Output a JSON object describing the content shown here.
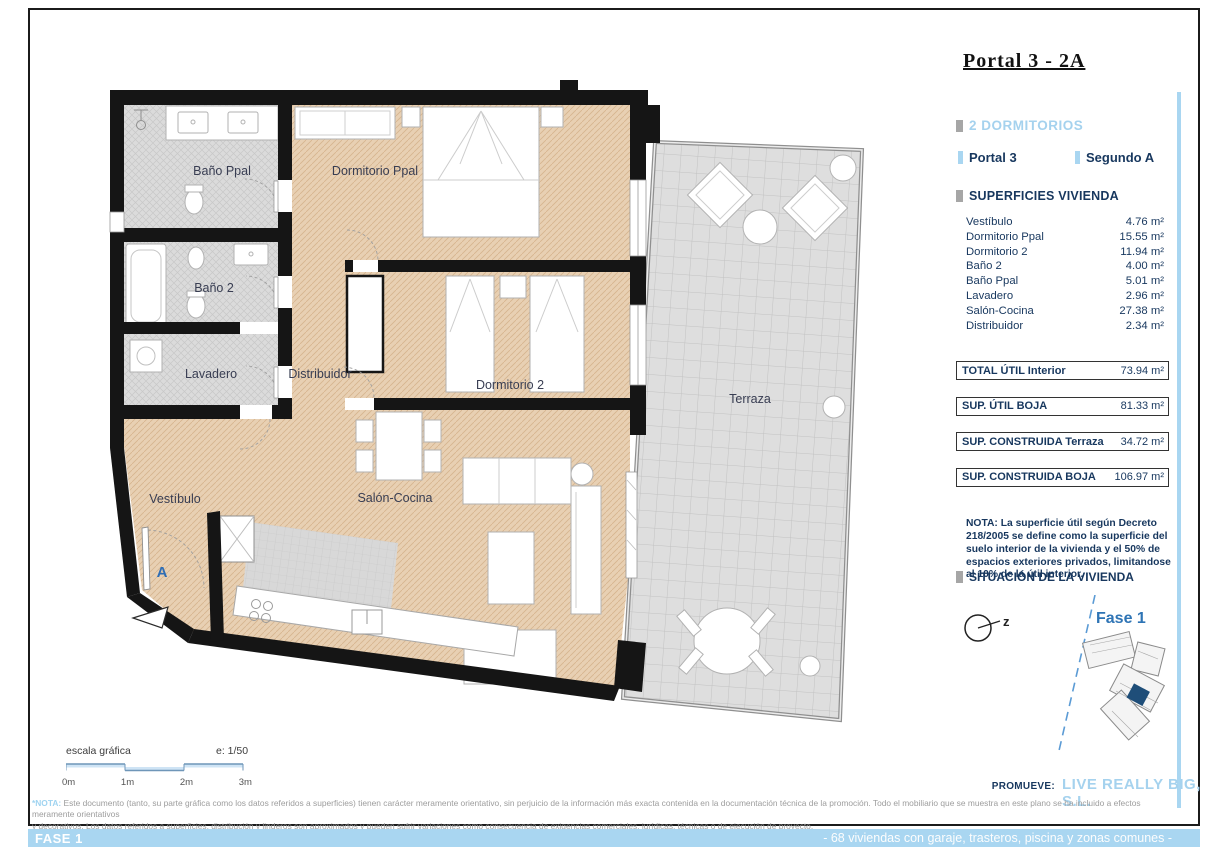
{
  "title": "Portal 3 - 2A",
  "panel": {
    "bedrooms_label": "2 DORMITORIOS",
    "portal_label": "Portal  3",
    "floor_label": "Segundo  A",
    "surfaces_header": "SUPERFICIES VIVIENDA",
    "rooms": [
      {
        "name": "Vestíbulo",
        "area": "4.76 m²"
      },
      {
        "name": "Dormitorio Ppal",
        "area": "15.55 m²"
      },
      {
        "name": "Dormitorio 2",
        "area": "11.94 m²"
      },
      {
        "name": "Baño 2",
        "area": "4.00 m²"
      },
      {
        "name": "Baño Ppal",
        "area": "5.01 m²"
      },
      {
        "name": "Lavadero",
        "area": "2.96 m²"
      },
      {
        "name": "Salón-Cocina",
        "area": "27.38 m²"
      },
      {
        "name": "Distribuidor",
        "area": "2.34 m²"
      }
    ],
    "totals": [
      {
        "label": "TOTAL ÚTIL Interior",
        "value": "73.94 m²"
      },
      {
        "label": "SUP.  ÚTIL BOJA",
        "value": "81.33 m²"
      },
      {
        "label": "SUP. CONSTRUIDA Terraza",
        "value": "34.72 m²"
      },
      {
        "label": "SUP. CONSTRUIDA BOJA",
        "value": "106.97 m²"
      }
    ],
    "nota": "NOTA: La superficie útil según Decreto 218/2005 se define como la superficie del suelo interior de la vivienda y el 50% de espacios exteriores privados, limitandose al 10% de la útil interior.",
    "situacion_header": "SITUACIÓN DE LA VIVIENDA",
    "compass_label": "z",
    "fase_label": "Fase 1",
    "promueve_label": "PROMUEVE:",
    "promueve_value": "LIVE REALLY BIG, S.L."
  },
  "plan": {
    "labels": {
      "bano_ppal": "Baño Ppal",
      "dormitorio_ppal": "Dormitorio Ppal",
      "bano_2": "Baño 2",
      "lavadero": "Lavadero",
      "distribuidor": "Distribuidor",
      "dormitorio_2": "Dormitorio 2",
      "terraza": "Terraza",
      "vestibulo": "Vestíbulo",
      "salon_cocina": "Salón-Cocina",
      "door_marker": "A"
    }
  },
  "scalebar": {
    "label": "escala gráfica",
    "scale": "e: 1/50",
    "ticks": [
      "0m",
      "1m",
      "2m",
      "3m"
    ]
  },
  "footnote": {
    "prefix": "*NOTA:",
    "line1": " Este documento (tanto, su parte gráfica como los datos referidos a superficies) tienen carácter meramente orientativo, sin perjuicio de la información más exacta contenida en la documentación técnica de la promoción. Todo el mobiliario que se muestra en este plano se ha incluido a efectos meramente orientativos",
    "line2": "y decorativos. Los datos referidos a superficies, distribución y linderos son aproximados y pueden sufrir variaciones como consecuencia de exigencias comerciales, jurídicas, técnicas o de ejecución de proyecto."
  },
  "bottom_bar": {
    "left": "FASE 1",
    "right": "- 68 viviendas con garaje, trasteros, piscina y zonas comunes -"
  },
  "colors": {
    "accent_blue": "#a9d6f1",
    "navy": "#17375e",
    "fase_blue": "#2e74b5",
    "room_tan": "#e8d0b3",
    "room_gray": "#dadada",
    "wall_black": "#151515"
  }
}
